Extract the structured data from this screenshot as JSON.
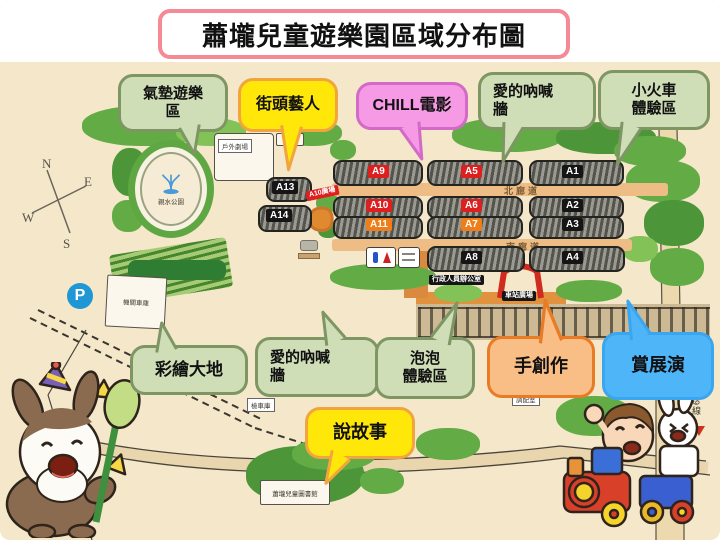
{
  "title": "蕭壠兒童遊樂園區域分布圖",
  "bubbles": {
    "air_cushion": {
      "line1": "氣墊遊樂",
      "line2": "區"
    },
    "street_artist": {
      "label": "街頭藝人"
    },
    "chill_movie": {
      "label": "CHILL電影"
    },
    "love_shout_top": {
      "line1": "愛的吶喊",
      "line2": "牆"
    },
    "mini_train": {
      "line1": "小火車",
      "line2": "體驗區"
    },
    "painted_land": {
      "label": "彩繪大地"
    },
    "love_shout_bottom": {
      "line1": "愛的吶喊",
      "line2": "牆"
    },
    "bubble_zone": {
      "line1": "泡泡",
      "line2": "體驗區"
    },
    "hand_craft": {
      "label": "手創作"
    },
    "exhibition": {
      "label": "賞展演"
    },
    "storytelling": {
      "label": "說故事"
    }
  },
  "map": {
    "compass": {
      "n": "N",
      "e": "E",
      "w": "W",
      "s": "S"
    },
    "water_park": "親水公園",
    "outdoor_theater": "戶外劇場",
    "north_corridor": "北廊道",
    "south_corridor": "南廊道",
    "a10_plaza": "A10廣場",
    "admin_office": "行政人員辦公室",
    "station_plaza": "車站廣場",
    "parking": "P",
    "locomotive_garage": "機關車庫",
    "inspection_garage": "檢車庫",
    "dispatch_room": "調配室",
    "side_gate": {
      "line1": "園區",
      "line2": "側門"
    },
    "library": "蕭壠兒童圖書館",
    "route_19": "19線",
    "buildings": {
      "a1": "A1",
      "a2": "A2",
      "a3": "A3",
      "a4": "A4",
      "a5": "A5",
      "a6": "A6",
      "a7": "A7",
      "a8": "A8",
      "a9": "A9",
      "a10": "A10",
      "a11": "A11",
      "a13": "A13",
      "a14": "A14"
    }
  },
  "colors": {
    "map_background": "#f4e7ca",
    "title_border": "#f58a96",
    "green_bubble": "#cfdeb7",
    "green_border": "#7e9663",
    "yellow_bubble": "#ffe70a",
    "yellow_border": "#f2a43e",
    "pink_bubble": "#f79ae5",
    "pink_border": "#d36ac8",
    "orange_bubble": "#f9bd86",
    "orange_border": "#e97b25",
    "blue_bubble": "#4eb5f8",
    "red_label": "#de1f1f",
    "orange_label": "#ef7d1a",
    "black_label": "#151515",
    "corridor_road": "#edbd85",
    "tree_green": "#63ac45"
  }
}
